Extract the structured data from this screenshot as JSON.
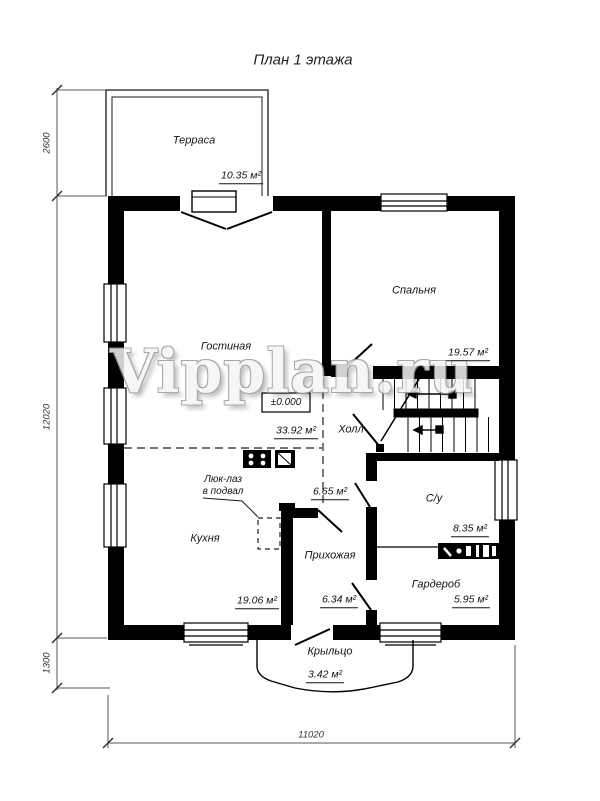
{
  "title": "План 1 этажа",
  "watermark": "Vipplan.ru",
  "elevation_mark": "±0.000",
  "rooms": {
    "terrace": {
      "name": "Терраса",
      "area": "10.35 м²"
    },
    "living": {
      "name": "Гостиная",
      "area": "33.92 м²"
    },
    "bedroom": {
      "name": "Спальня",
      "area": "19.57 м²"
    },
    "hall": {
      "name": "Холл",
      "area": "6.65 м²"
    },
    "bathroom": {
      "name": "С/у",
      "area": "8.35 м²"
    },
    "kitchen": {
      "name": "Кухня",
      "area": "19.06 м²"
    },
    "entry": {
      "name": "Прихожая",
      "area": "6.34 м²"
    },
    "wardrobe": {
      "name": "Гардероб",
      "area": "5.95 м²"
    },
    "porch": {
      "name": "Крыльцо",
      "area": "3.42 м²"
    }
  },
  "hatch": {
    "line1": "Люк-лаз",
    "line2": "в подвал"
  },
  "dimensions": {
    "terrace_depth": "2600",
    "house_depth": "12020",
    "porch_depth": "1300",
    "house_width": "11020"
  },
  "colors": {
    "wall": "#000000",
    "dim_line": "#555555",
    "paper": "#ffffff"
  }
}
